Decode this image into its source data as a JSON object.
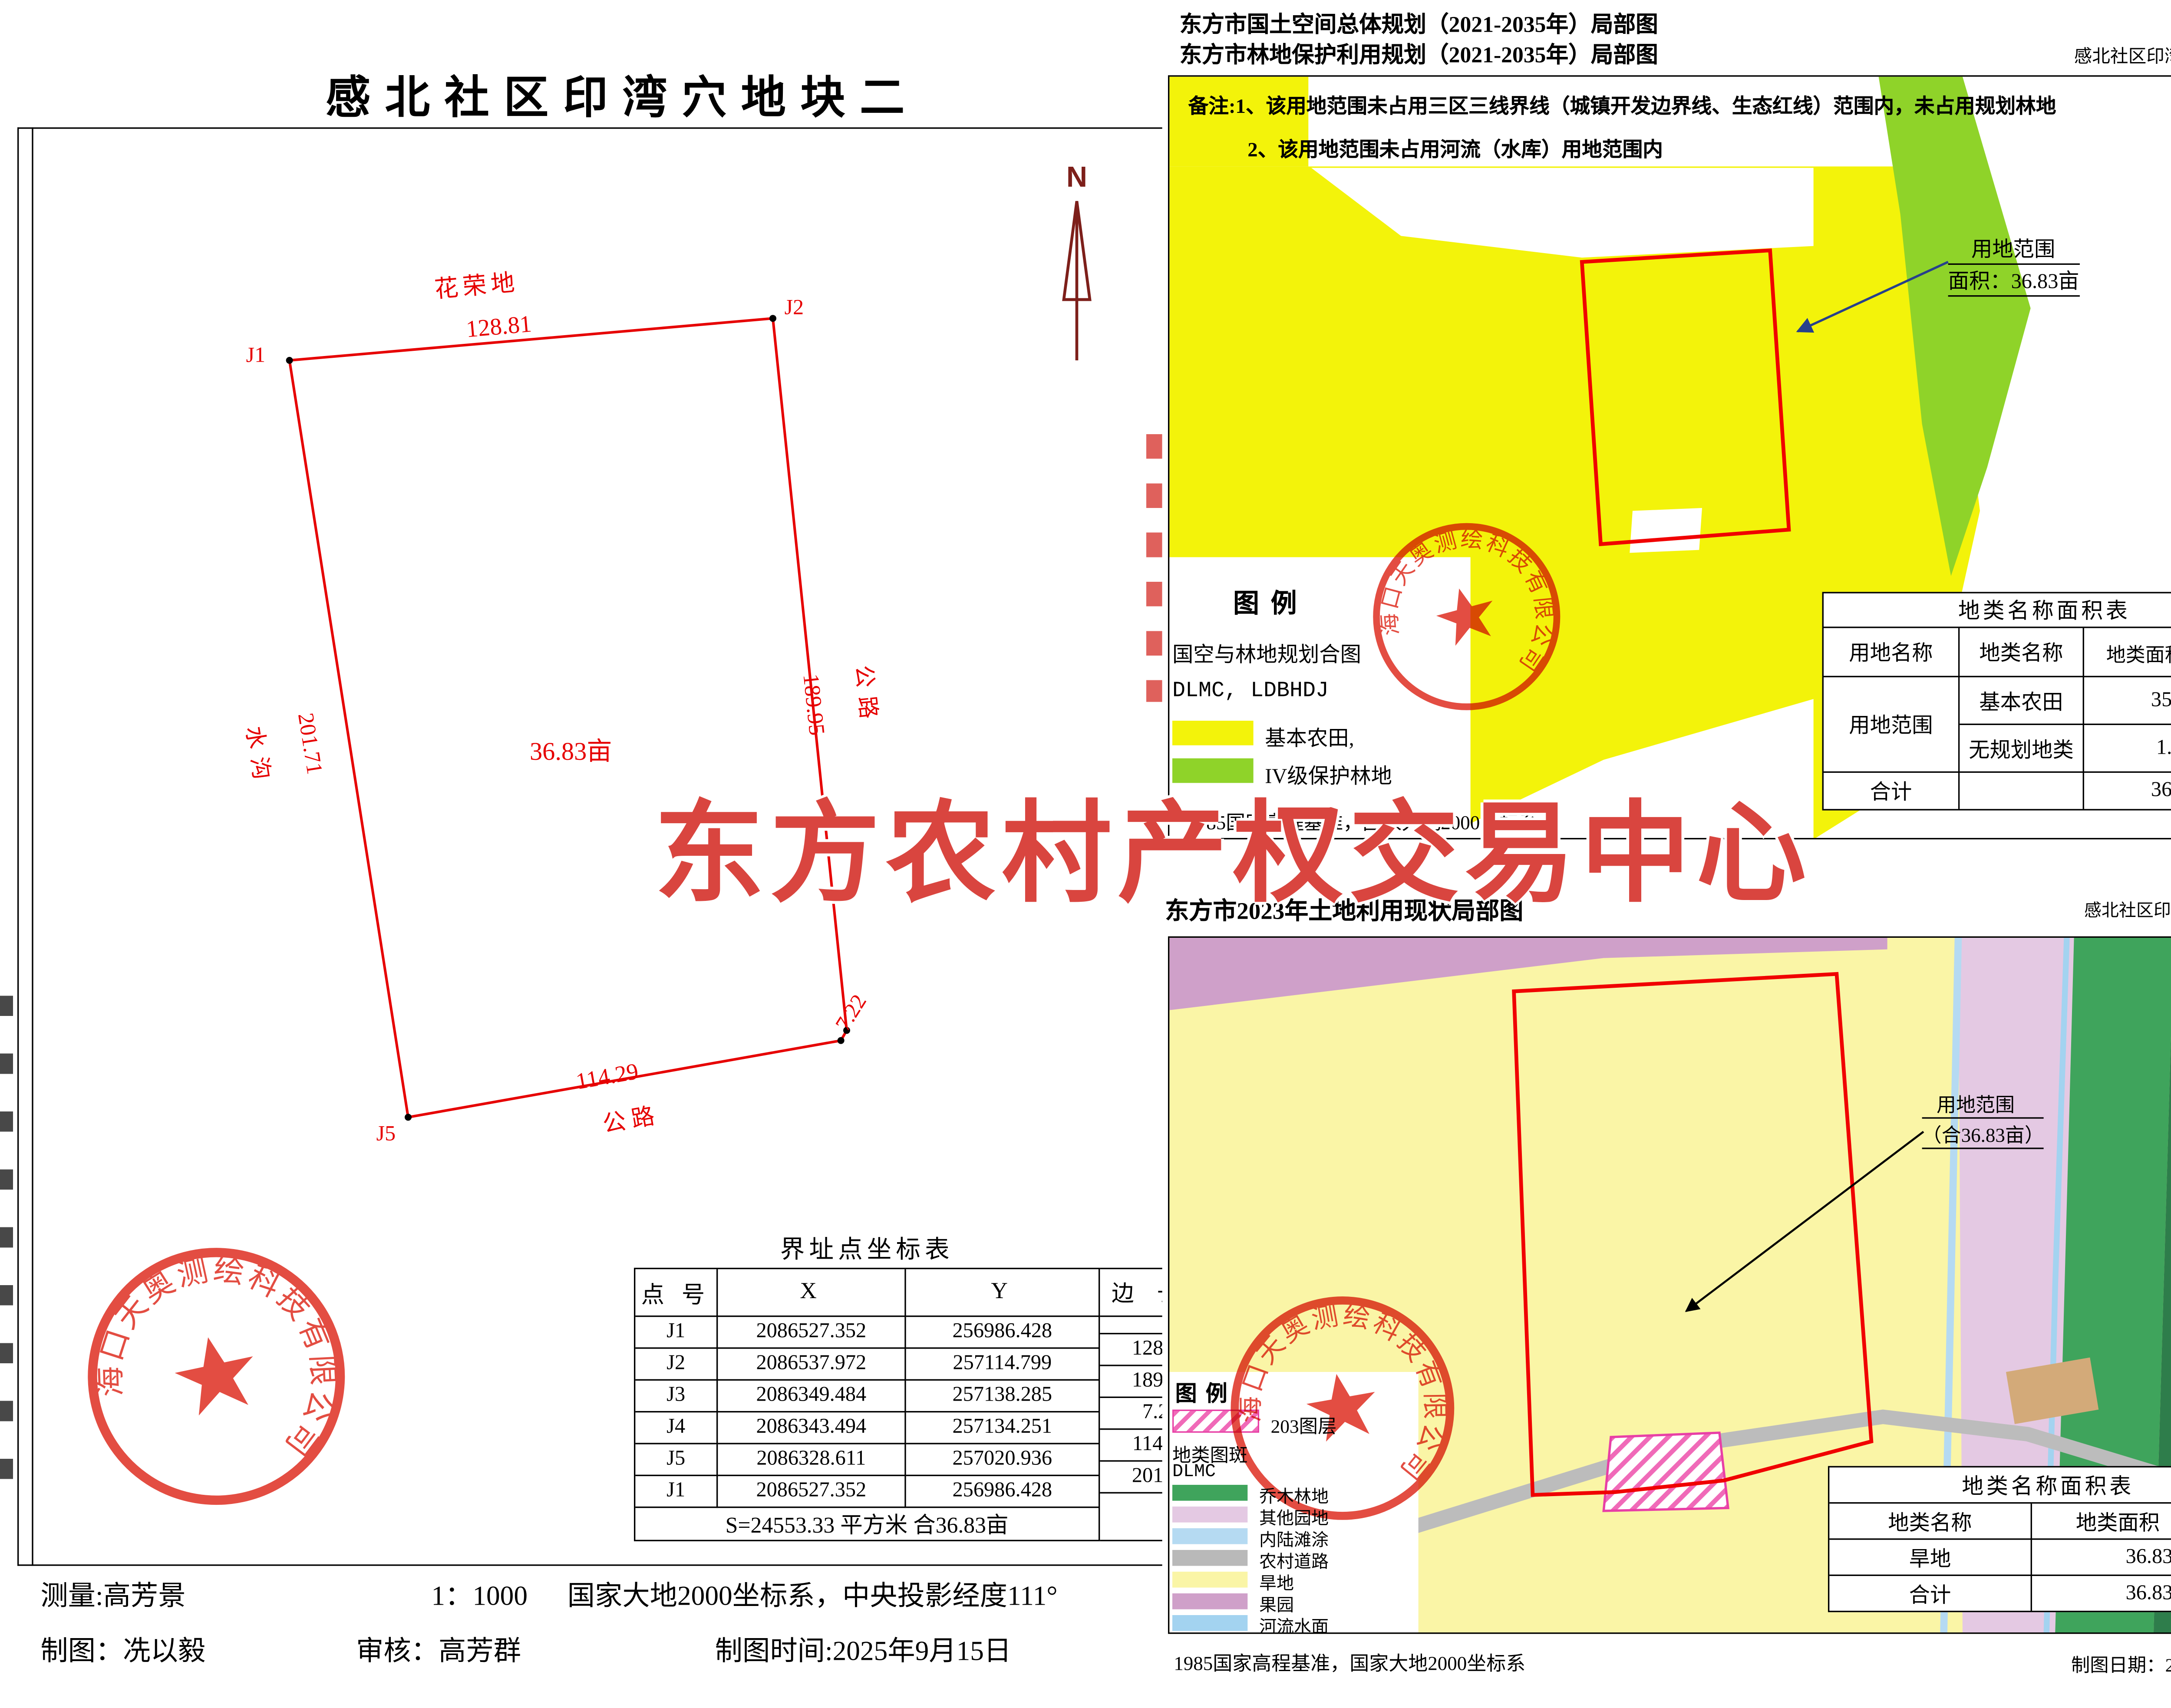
{
  "watermark_text": "东方农村产权交易中心",
  "colors": {
    "annotation_red": "#e60000",
    "stamp_red": "#e03428",
    "watermark_red": "#d9453f",
    "plan_yellow": "#f3f30a",
    "plan_green": "#8fd329",
    "landuse_yellow": "#faf5a6",
    "landuse_mauve": "#cfa0c9",
    "landuse_pink": "#e4c9e3",
    "landuse_green": "#3fa45c",
    "landuse_dark_green": "#2e7d4b",
    "river_blue": "#a3d3f0",
    "mudflat_blue": "#b5daf2",
    "road_gray": "#b9b9b9",
    "facility_tan": "#d3aa79",
    "hatch_magenta": "#e83fa6"
  },
  "left_sheet": {
    "title": "感北社区印湾穴地块二",
    "north_label": "N",
    "parcel": {
      "area": "36.83亩",
      "v1": "J1",
      "v2": "J2",
      "v5": "J5",
      "edge_top_name": "花荣地",
      "edge_top_len": "128.81",
      "edge_right_name": "公路",
      "edge_right_len": "189.95",
      "edge_small_len": "7.22",
      "edge_bottom_name": "公路",
      "edge_bottom_len": "114.29",
      "edge_left_name": "水沟",
      "edge_left_len": "201.71"
    },
    "coord_table": {
      "title": "界址点坐标表",
      "h_point": "点 号",
      "h_x": "X",
      "h_y": "Y",
      "h_len": "边 长",
      "rows": [
        [
          "J1",
          "2086527.352",
          "256986.428"
        ],
        [
          "J2",
          "2086537.972",
          "257114.799"
        ],
        [
          "J3",
          "2086349.484",
          "257138.285"
        ],
        [
          "J4",
          "2086343.494",
          "257134.251"
        ],
        [
          "J5",
          "2086328.611",
          "257020.936"
        ],
        [
          "J1",
          "2086527.352",
          "256986.428"
        ]
      ],
      "edge_lengths": [
        "128.81",
        "189.95",
        "7.22",
        "114.29",
        "201.71"
      ],
      "summary": "S=24553.33 平方米 合36.83亩"
    },
    "footer": {
      "surveyor": "测量:高芳景",
      "scale": "1：1000",
      "datum": "国家大地2000坐标系，中央投影经度111°",
      "drafter": "制图：冼以毅",
      "checker": "审核：高芳群",
      "date": "制图时间:2025年9月15日"
    },
    "stamp_text": "海口天奥测绘科技有限公司"
  },
  "top_right_panel": {
    "title_line1": "东方市国土空间总体规划（2021-2035年）局部图",
    "title_line2": "东方市林地保护利用规划（2021-2035年）局部图",
    "subtitle": "感北社区印湾穴地块二",
    "note_line1": "备注:1、该用地范围未占用三区三线界线（城镇开发边界线、生态红线）范围内，未占用规划林地",
    "note_line2": "2、该用地范围未占用河流（水库）用地范围内",
    "north_label": "N",
    "callout_line1": "用地范围",
    "callout_line2": "面积：36.83亩",
    "legend": {
      "title": "图例",
      "subtitle": "国空与林地规划合图",
      "codes": "DLMC, LDBHDJ",
      "items": [
        {
          "label": "基本农田,",
          "color": "#f3f30a"
        },
        {
          "label": "IV级保护林地",
          "color": "#8fd329"
        }
      ]
    },
    "area_table": {
      "title": "地类名称面积表",
      "h1": "用地名称",
      "h2": "地类名称",
      "h3": "地类面积（亩）",
      "group": "用地范围",
      "r1_name": "基本农田",
      "r1_val": "35.65",
      "r2_name": "无规划地类",
      "r2_val": "1.18",
      "total_label": "合计",
      "total_val": "36.83"
    },
    "datum_note": "1985国家高程基准，国家大地2000坐标系",
    "map_date": "制图日期：2025年9月",
    "stamp_text": "海口天奥测绘科技有限公司"
  },
  "bottom_right_panel": {
    "title": "东方市2023年土地利用现状局部图",
    "subtitle": "感北社区印湾穴地块二",
    "north_label": "N",
    "callout_line1": "用地范围",
    "callout_line2": "（合36.83亩）",
    "legend": {
      "title": "图例",
      "hatch_label": "203图层",
      "sub1": "地类图斑",
      "sub2": "DLMC",
      "items": [
        {
          "label": "乔木林地",
          "color": "#3fa45c"
        },
        {
          "label": "其他园地",
          "color": "#e4c9e3"
        },
        {
          "label": "内陆滩涂",
          "color": "#b5daf2"
        },
        {
          "label": "农村道路",
          "color": "#b9b9b9"
        },
        {
          "label": "旱地",
          "color": "#faf5a6"
        },
        {
          "label": "果园",
          "color": "#cfa0c9"
        },
        {
          "label": "河流水面",
          "color": "#a3d3f0"
        },
        {
          "label": "设施农用地",
          "color": "#d3aa79"
        }
      ]
    },
    "area_table": {
      "title": "地类名称面积表",
      "h1": "地类名称",
      "h2": "地类面积（亩）",
      "r1_name": "旱地",
      "r1_val": "36.83",
      "total_label": "合计",
      "total_val": "36.83"
    },
    "datum_note": "1985国家高程基准，国家大地2000坐标系",
    "map_date": "制图日期：2025年9月",
    "stamp_text": "海口天奥测绘科技有限公司"
  }
}
